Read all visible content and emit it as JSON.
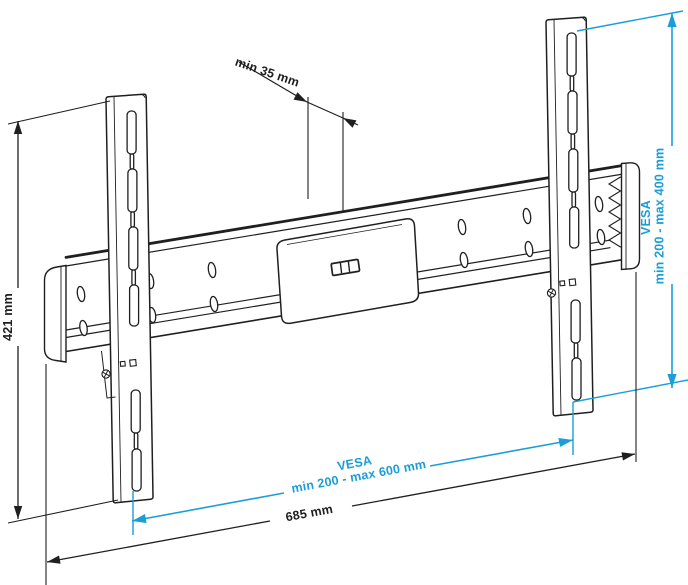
{
  "diagram": {
    "subject": "flat-tv-wall-mount-dimension-drawing",
    "colors": {
      "line": "#1f1f1f",
      "accent_blue": "#1b9ed8",
      "background": "#ffffff"
    },
    "dimensions": {
      "height": "421 mm",
      "top_clearance": "min 35 mm",
      "vesa_vertical": {
        "name": "VESA",
        "range": "min 200 - max 400 mm"
      },
      "vesa_horizontal": {
        "name": "VESA",
        "range": "min 200 - max 600 mm"
      },
      "width": "685 mm"
    }
  }
}
